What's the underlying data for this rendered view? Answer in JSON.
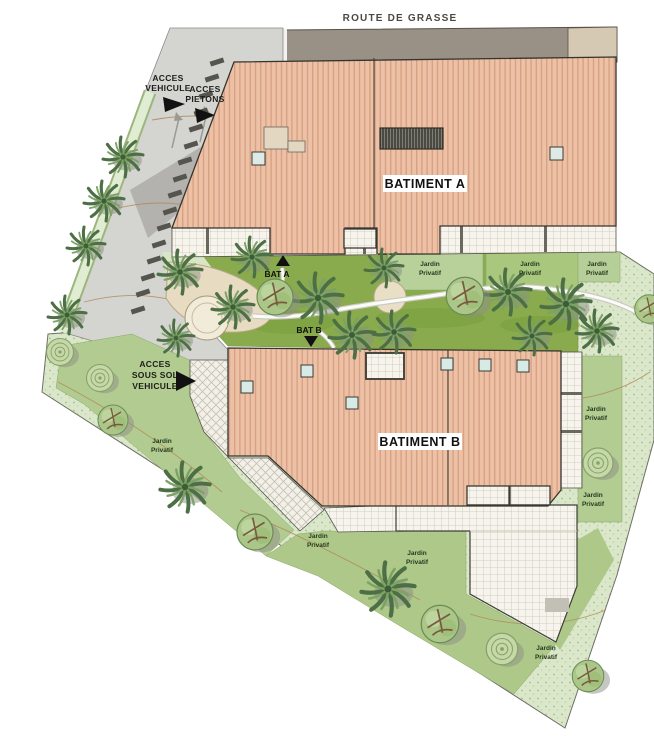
{
  "header": {
    "road_label": "ROUTE DE GRASSE"
  },
  "access": {
    "vehicle": {
      "line1": "ACCES",
      "line2": "VEHICULE"
    },
    "pedestrian": {
      "line1": "ACCES",
      "line2": "PIETONS"
    },
    "basement": {
      "line1": "ACCES",
      "line2": "SOUS SOL",
      "line3": "VEHICULE"
    }
  },
  "buildings": {
    "a": {
      "name": "BATIMENT A",
      "entry": "BAT A"
    },
    "b": {
      "name": "BATIMENT B",
      "entry": "BAT B"
    }
  },
  "garden": {
    "private1": "Jardin",
    "private2": "Privatif"
  },
  "palette": {
    "roof": "#edc1a6",
    "roof_stripe": "#d9a184",
    "road": "#9a9186",
    "road_shoulder": "#d5c9b3",
    "driveway": "#d4d4d1",
    "lawn": "#8aab4d",
    "garden_bright": "#b2cb90",
    "garden_pale": "#dbe7cb",
    "tile": "#f6f4ec",
    "path_beige": "#e7dcc2",
    "outline": "#35352e"
  }
}
